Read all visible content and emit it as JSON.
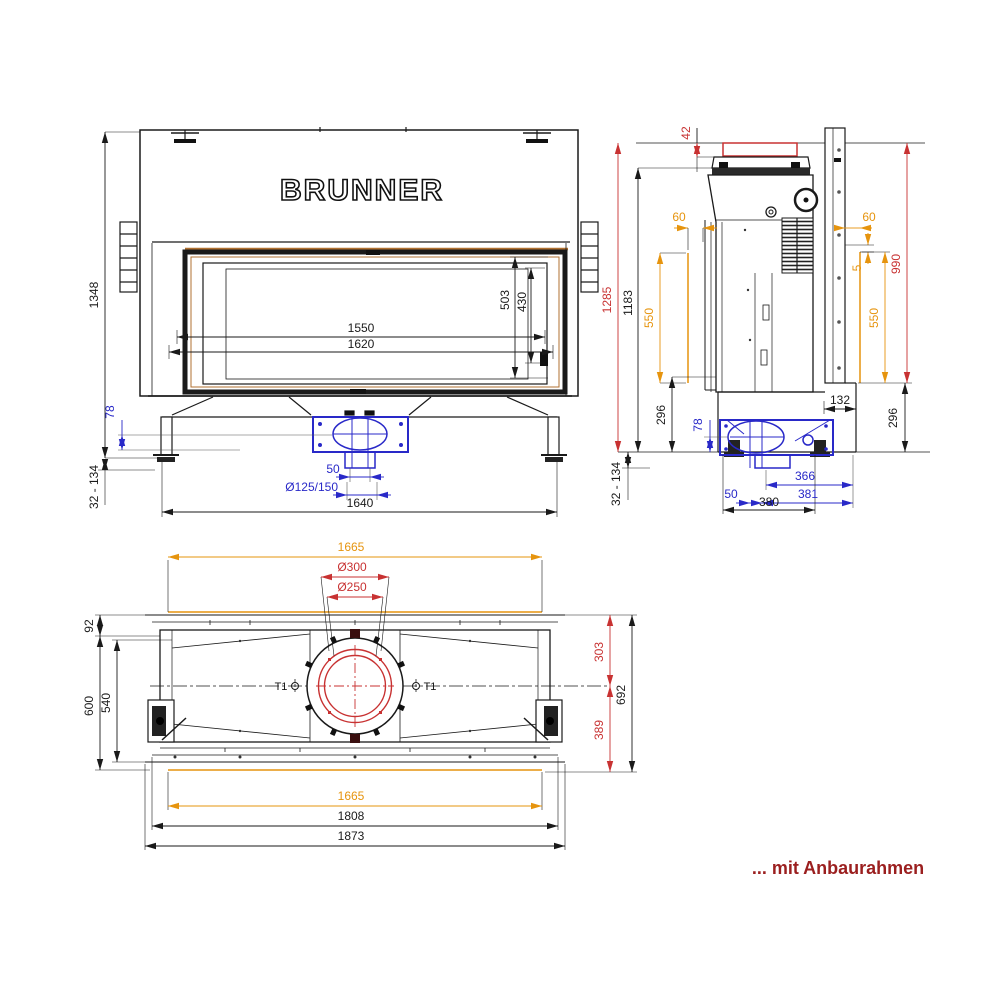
{
  "drawing_title": "BRUNNER",
  "caption": "... mit Anbaurahmen",
  "colors": {
    "line": "#1a1a1a",
    "dim_blue": "#2929c8",
    "dim_red": "#c83232",
    "dim_orange": "#e6940e",
    "caption_red": "#9b1f1f",
    "accent_brown": "#b07030"
  },
  "front": {
    "logo": "BRUNNER",
    "dims": {
      "h_total": "1348",
      "plinth": "78",
      "leg_range": "32 - 134",
      "glass_h": "503",
      "glass_h2": "430",
      "w_glass": "1550",
      "w_opening": "1620",
      "air_pitch": "50",
      "air_dia": "Ø125/150",
      "w_total": "1640"
    }
  },
  "side": {
    "dims": {
      "frame_top": "42",
      "h_frame": "1285",
      "h_body": "1183",
      "offset_left": "60",
      "slot_left": "550",
      "base_h_left": "296",
      "plinth": "78",
      "leg_range": "32 - 134",
      "air_pitch": "50",
      "air_back": "366",
      "air_back2": "381",
      "depth_total": "380",
      "depth_step": "132",
      "base_h_right": "296",
      "offset_right": "60",
      "gap": "5",
      "h_rail": "990",
      "slot_right": "550"
    }
  },
  "top": {
    "section_left": "T1",
    "section_right": "T1",
    "dims": {
      "frame_w_top": "1665",
      "flue_outer": "Ø300",
      "flue_inner": "Ø250",
      "front_edge": "92",
      "depth_body": "600",
      "depth_inner": "540",
      "flue_front": "303",
      "depth_total": "692",
      "flue_back": "389",
      "frame_w_bottom": "1665",
      "w_mid": "1808",
      "w_total": "1873"
    }
  }
}
